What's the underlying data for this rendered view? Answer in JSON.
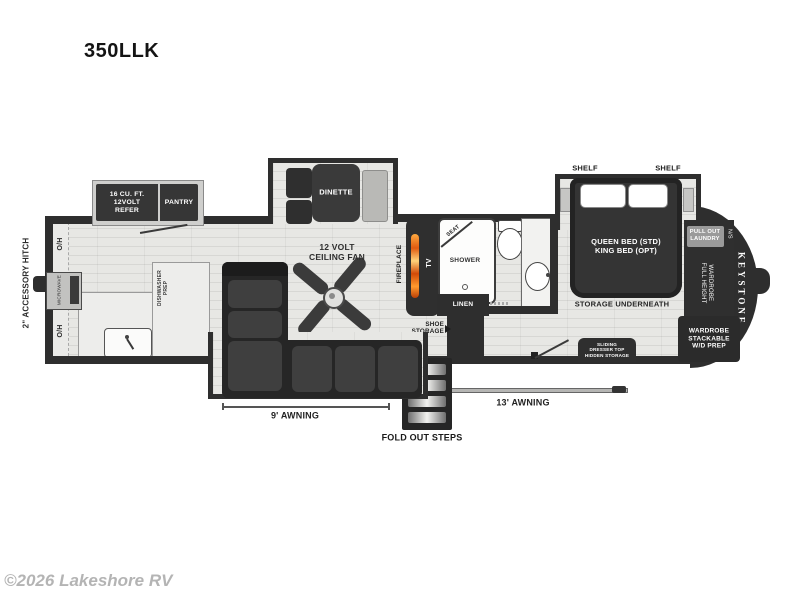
{
  "title": "350LLK",
  "copyright": "©2026 Lakeshore RV",
  "colors": {
    "wall": "#2e2e2e",
    "floor": "#e4e4e2",
    "counter": "#ededeb",
    "flame_accent": "#e8641b",
    "watermark_gray": "#b4b4b4"
  },
  "floorplan": {
    "hitch": "2\" ACCESSORY HITCH",
    "oh": "O/H",
    "microwave": "MICROWAVE",
    "refer": "16 CU. FT.\n12VOLT\nREFER",
    "pantry": "PANTRY",
    "dinette": "DINETTE",
    "ceiling_fan": "12 VOLT\nCEILING FAN",
    "dishwasher": "DISHWASHER\nPREP",
    "fireplace": "FIREPLACE",
    "tv": "TV",
    "seat": "SEAT",
    "shower": "SHOWER",
    "linen": "LINEN",
    "shoe_storage": "SHOE\nSTORAGE",
    "shelf": "SHELF",
    "bed": "QUEEN BED (STD)\nKING BED (OPT)",
    "storage_underneath": "STORAGE UNDERNEATH",
    "dresser": "SLIDING\nDRESSER TOP\nHIDDEN STORAGE",
    "laundry": "PULL OUT\nLAUNDRY",
    "ns": "N/S",
    "wardrobe_full": "FULL HEIGHT\nWARDROBE",
    "wardrobe_stack": "WARDROBE\nSTACKABLE\nW/D PREP",
    "keystone": "KEYSTONE",
    "awning9": "9' AWNING",
    "awning13": "13' AWNING",
    "steps": "FOLD OUT STEPS"
  }
}
